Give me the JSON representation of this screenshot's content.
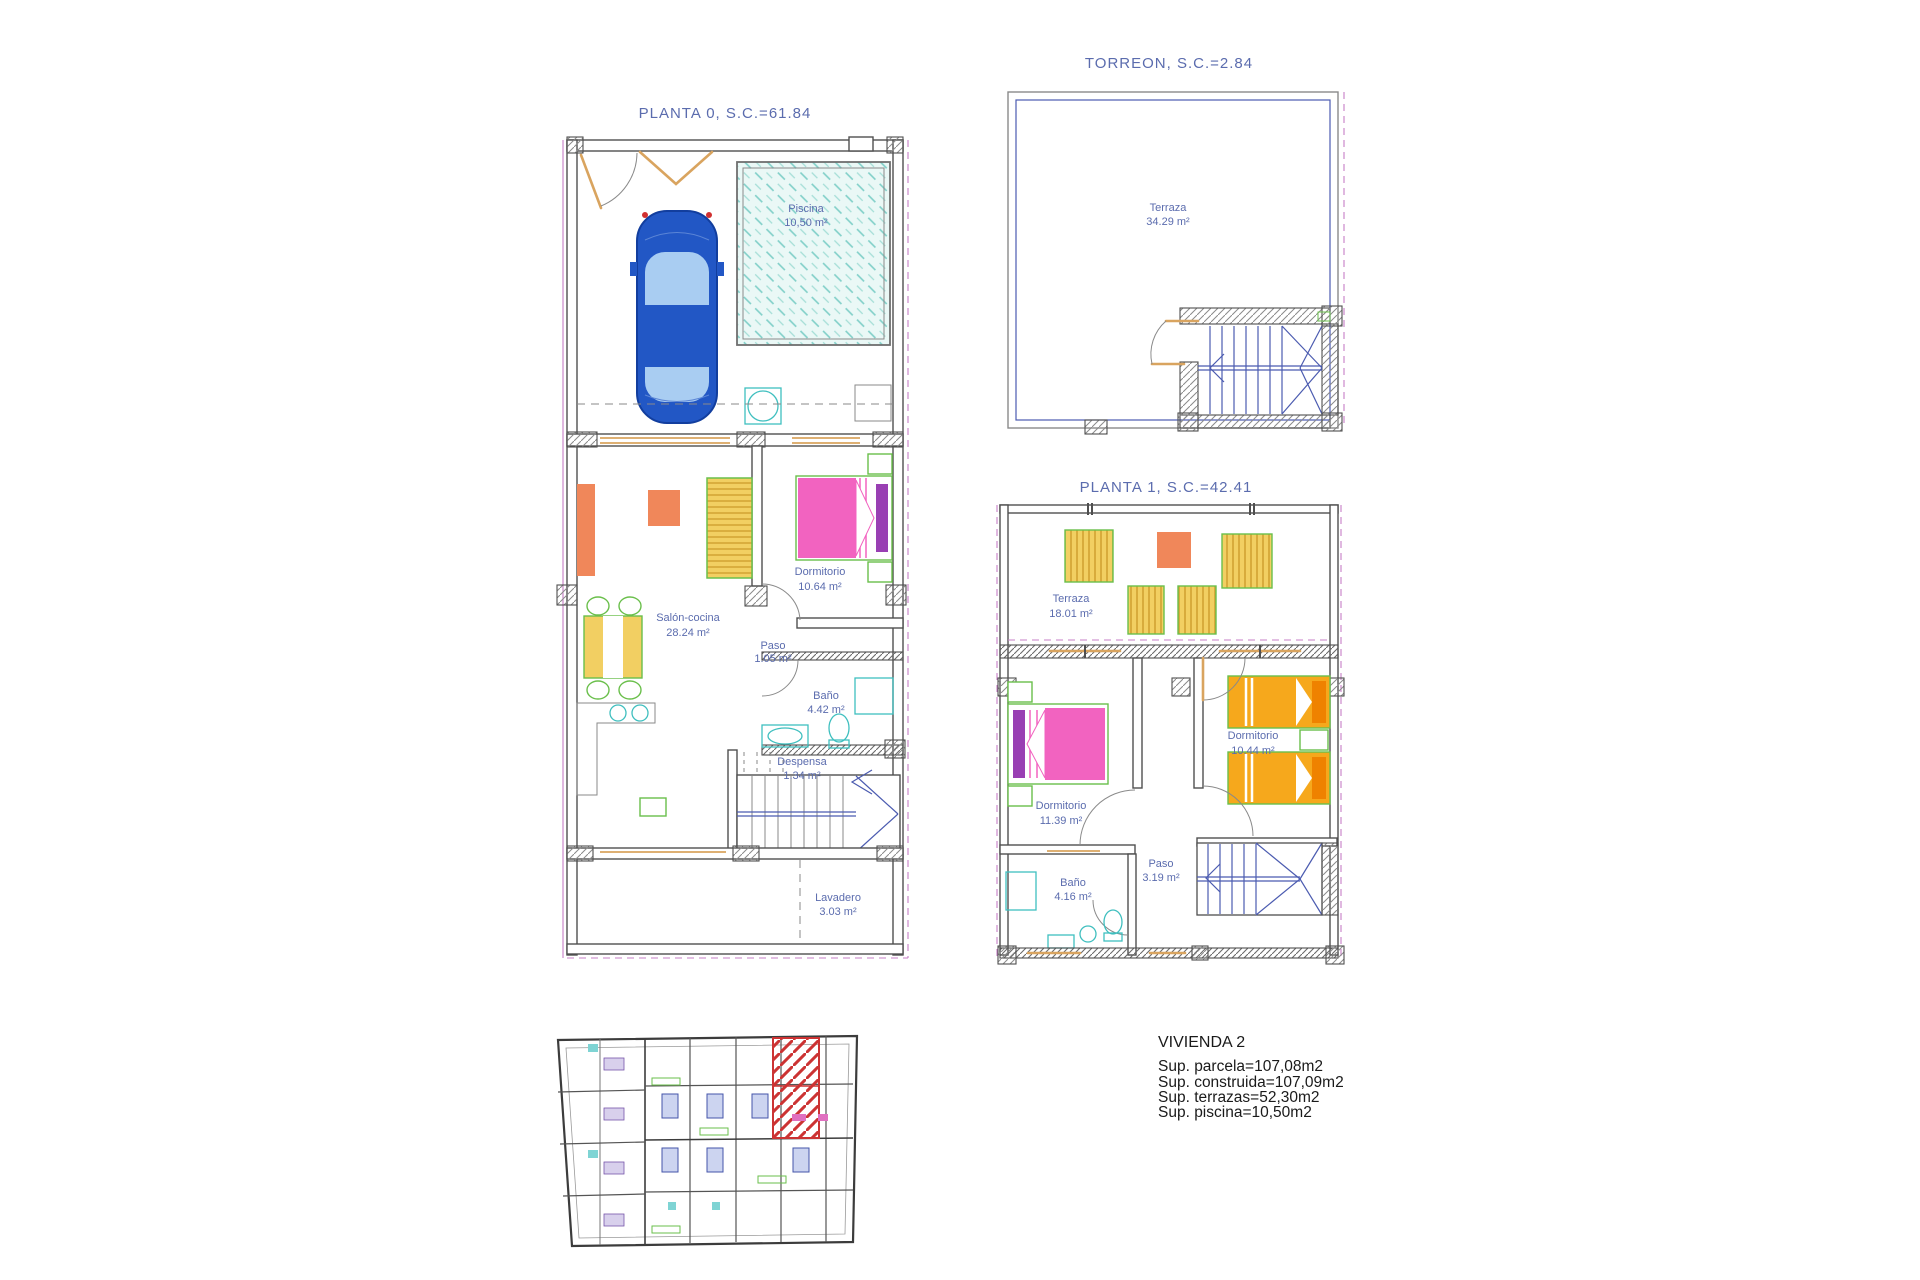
{
  "document": {
    "type": "architectural-floor-plan-sheet",
    "background": "#ffffff"
  },
  "plans": {
    "planta0": {
      "title": "PLANTA 0, S.C.=61.84",
      "rooms": {
        "piscina": {
          "name": "Piscina",
          "area": "10,50 m²"
        },
        "salon": {
          "name": "Salón-cocina",
          "area": "28.24 m²"
        },
        "dormitorio": {
          "name": "Dormitorio",
          "area": "10.64 m²"
        },
        "paso": {
          "name": "Paso",
          "area": "1.05 m²"
        },
        "bano": {
          "name": "Baño",
          "area": "4.42 m²"
        },
        "despensa": {
          "name": "Despensa",
          "area": "1.34 m²"
        },
        "lavadero": {
          "name": "Lavadero",
          "area": "3.03 m²"
        }
      }
    },
    "torreon": {
      "title": "TORREON, S.C.=2.84",
      "rooms": {
        "terraza": {
          "name": "Terraza",
          "area": "34.29 m²"
        }
      }
    },
    "planta1": {
      "title": "PLANTA 1, S.C.=42.41",
      "rooms": {
        "terraza": {
          "name": "Terraza",
          "area": "18.01 m²"
        },
        "dormitorio1": {
          "name": "Dormitorio",
          "area": "11.39 m²"
        },
        "dormitorio2": {
          "name": "Dormitorio",
          "area": "10.44 m²"
        },
        "paso": {
          "name": "Paso",
          "area": "3.19 m²"
        },
        "bano": {
          "name": "Baño",
          "area": "4.16 m²"
        }
      }
    }
  },
  "summary": {
    "title": "VIVIENDA 2",
    "lines": [
      "Sup. parcela=107,08m2",
      "Sup. construida=107,09m2",
      "Sup. terrazas=52,30m2",
      "Sup. piscina=10,50m2"
    ]
  },
  "colors": {
    "label_blue": "#5b6cae",
    "wall_gray": "#4f4f4f",
    "carpentry_orange": "#d9a45f",
    "boundary_magenta": "#c77fc7",
    "fixture_cyan": "#3fbfbf",
    "furniture_yellow": "#f2cf62",
    "furniture_green": "#6abf4b",
    "furniture_orange": "#f0875a",
    "bed_pink": "#f263c0",
    "pillow_purple": "#993fb3",
    "bed_orange": "#f6a81c",
    "pillow_orange": "#ef8200",
    "car_blue": "#2257c5",
    "car_glass": "#a9cdf2",
    "highlight_red": "#cc3333",
    "pool_water": "#eaf8f6",
    "stair_blue": "#4b5bb0"
  }
}
